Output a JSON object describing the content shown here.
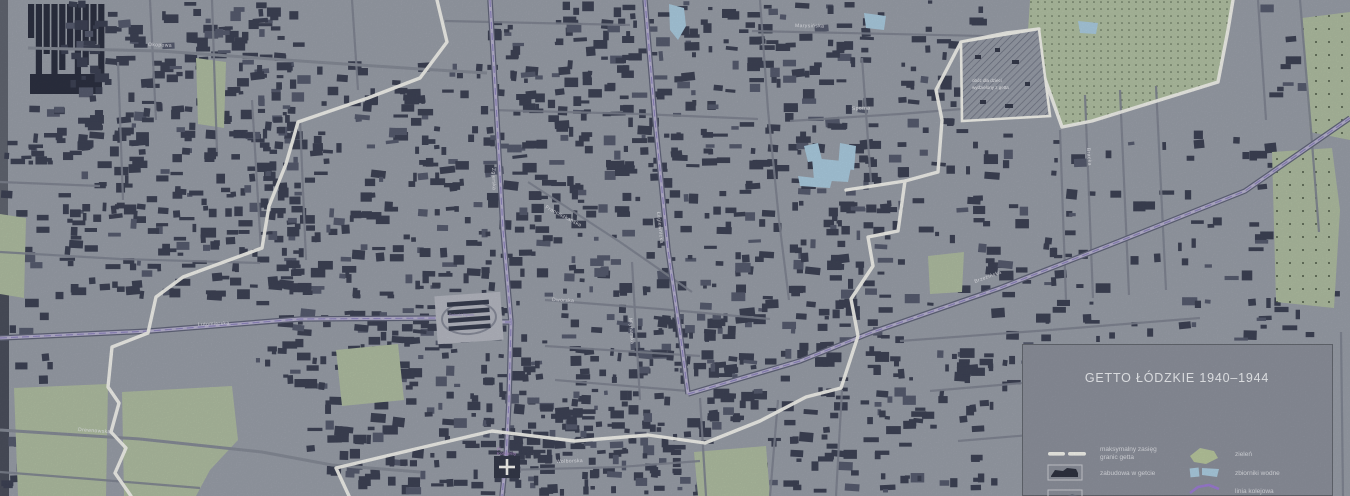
{
  "map": {
    "street_labels": [
      {
        "text": "Okopowa",
        "x": 148,
        "y": 46,
        "angle": 2
      },
      {
        "text": "Zgierska",
        "x": 492,
        "y": 168,
        "angle": 88
      },
      {
        "text": "Łagiewnicka",
        "x": 657,
        "y": 212,
        "angle": 84
      },
      {
        "text": "Lutomierska",
        "x": 198,
        "y": 326,
        "angle": -3
      },
      {
        "text": "Drewnowska",
        "x": 78,
        "y": 431,
        "angle": 4
      },
      {
        "text": "Dworska",
        "x": 552,
        "y": 301,
        "angle": 3
      },
      {
        "text": "Wolborska",
        "x": 556,
        "y": 463,
        "angle": -2
      },
      {
        "text": "Brzezińska",
        "x": 975,
        "y": 283,
        "angle": -20
      },
      {
        "text": "Marysińska",
        "x": 795,
        "y": 27,
        "angle": 1
      },
      {
        "text": "Sporna",
        "x": 852,
        "y": 110,
        "angle": -2
      },
      {
        "text": "Bracka",
        "x": 1087,
        "y": 148,
        "angle": 86
      },
      {
        "text": "Franciszkańska",
        "x": 545,
        "y": 208,
        "angle": 28
      },
      {
        "text": "Młynarska",
        "x": 629,
        "y": 318,
        "angle": 86
      }
    ],
    "landmarks": {
      "balucki_rynek": "Bałucki Rynek",
      "koscielny_square_line1": "pl.",
      "koscielny_square_line2": "Kościelny",
      "camp_line1": "obóz dla dzieci",
      "camp_line2": "wydzielony z getta"
    }
  },
  "legend": {
    "title": "GETTO ŁÓDZKIE 1940–1944",
    "left_items": [
      {
        "label_line1": "maksymalny zasięg",
        "label_line2": "granic getta",
        "swatch": "boundary-line"
      },
      {
        "label_line1": "zabudowa w getcie",
        "label_line2": "",
        "swatch": "ghetto-buildings"
      },
      {
        "label_line1": "",
        "label_line2": "",
        "swatch": "buildings-box-2"
      }
    ],
    "right_items": [
      {
        "label": "zieleń",
        "swatch": "greenery"
      },
      {
        "label": "zbiorniki wodne",
        "swatch": "water"
      },
      {
        "label": "linia kolejowa",
        "swatch": "railway"
      }
    ]
  },
  "colors": {
    "map_background": "#999ea8",
    "buildings": "#3d4254",
    "buildings_light": "#565b6e",
    "greenery": "#aebca0",
    "water": "#a9cade",
    "ghetto_boundary": "#f2f2ec",
    "railway_purple": "#9a7bd0",
    "road_major_fill": "#b7b2cf",
    "legend_background": "#8b8f9a"
  }
}
